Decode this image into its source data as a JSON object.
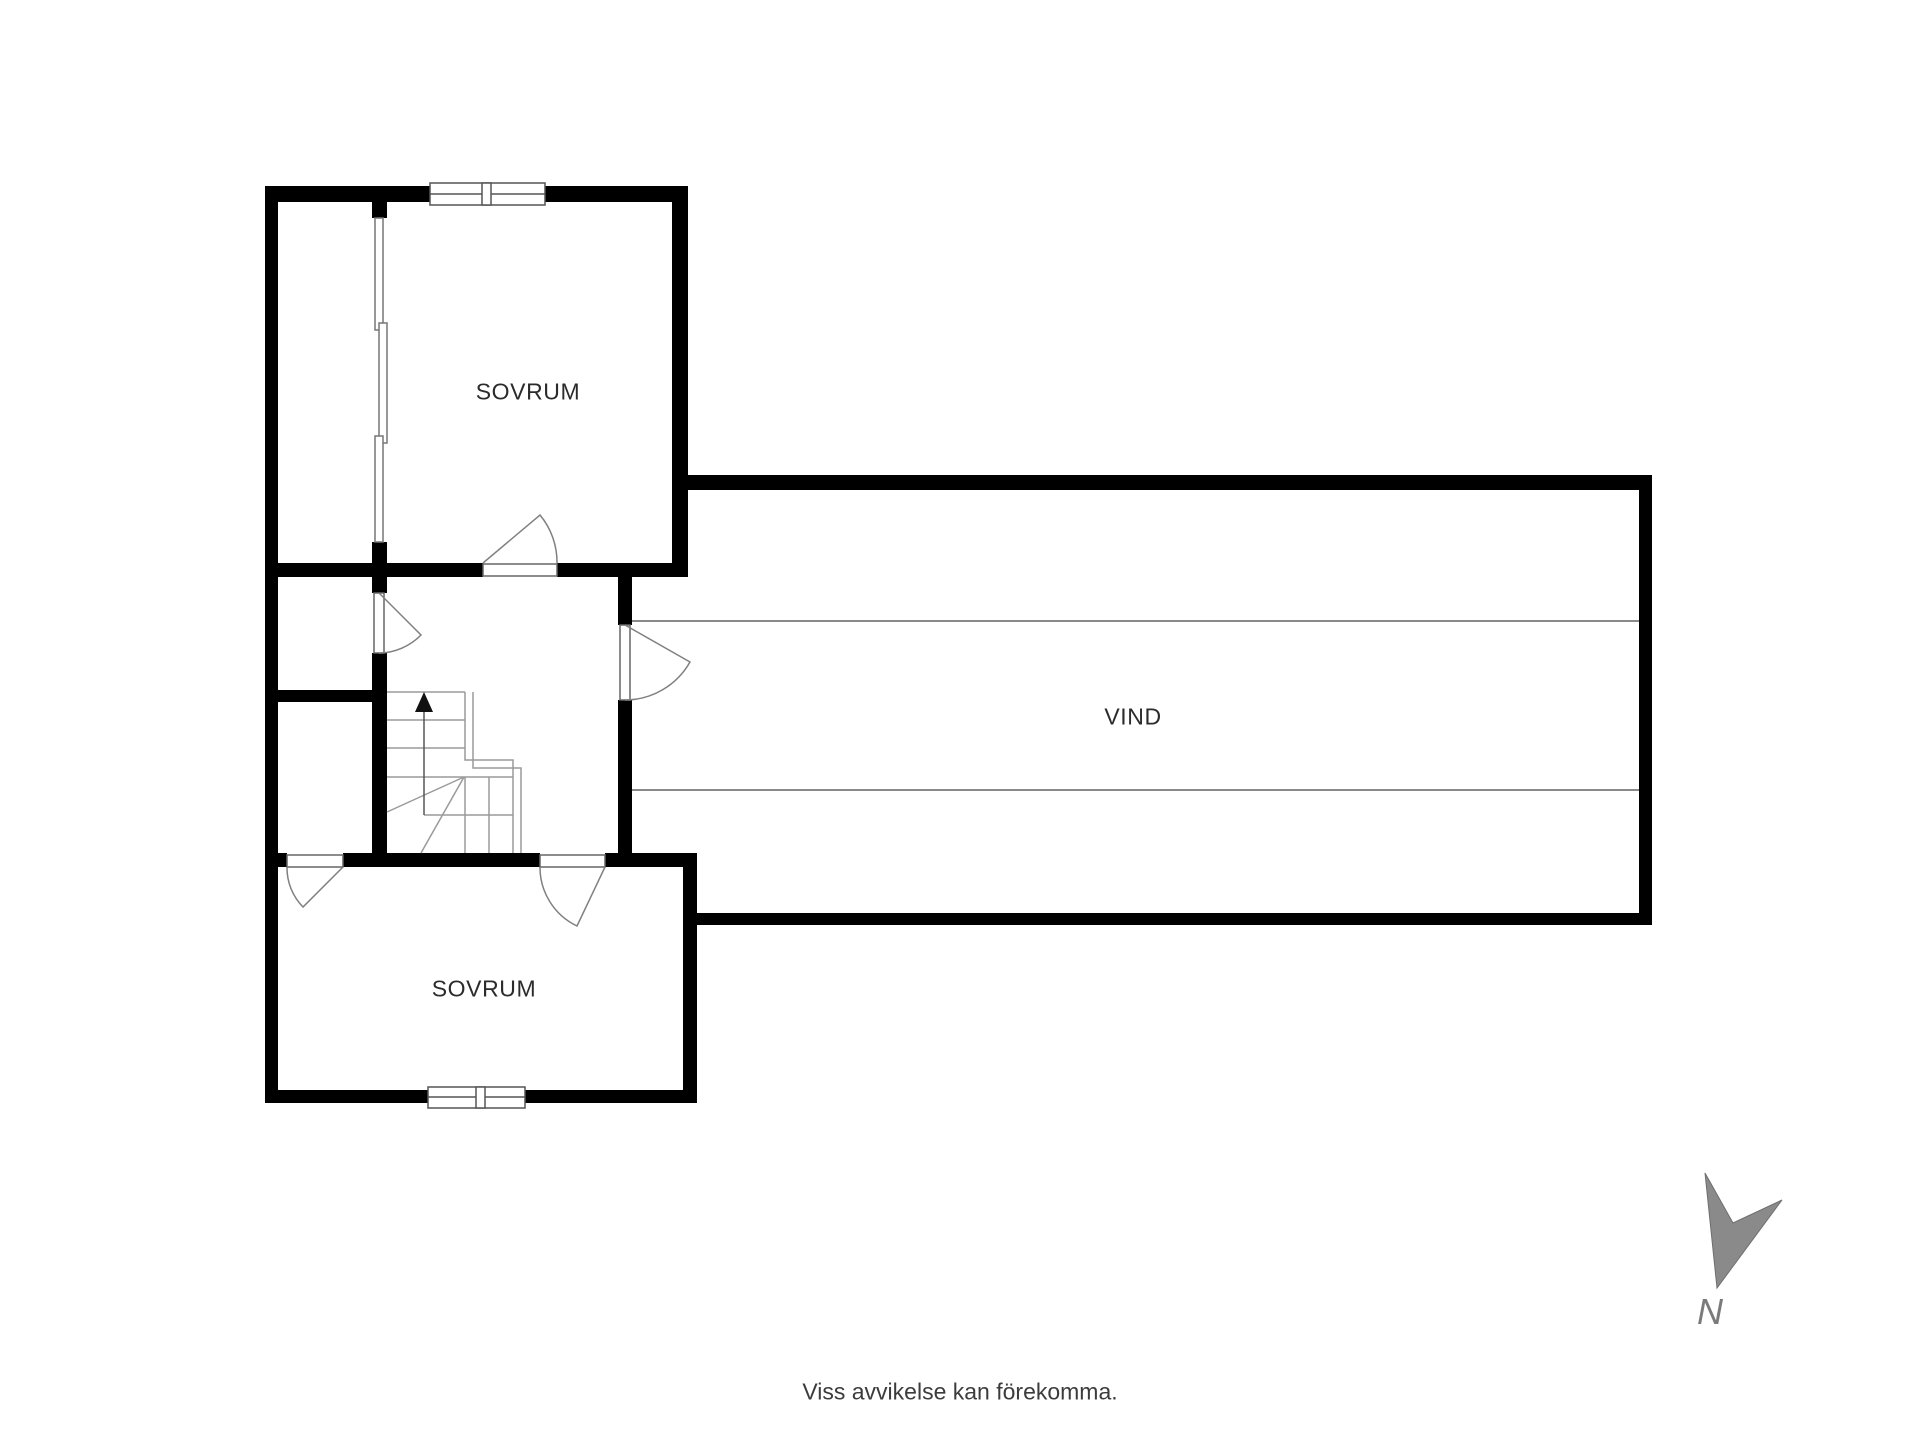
{
  "page": {
    "background_color": "#ffffff",
    "disclaimer": "Viss avvikelse kan förekomma."
  },
  "floorplan": {
    "rooms": [
      {
        "name": "sovrum-top",
        "label": "SOVRUM"
      },
      {
        "name": "vind",
        "label": "VIND"
      },
      {
        "name": "sovrum-bottom",
        "label": "SOVRUM"
      }
    ],
    "compass": {
      "label": "N"
    },
    "colors": {
      "wall": "#000000",
      "stair_line": "#9a9a9a",
      "attic_knee_line": "#8a8a8a",
      "door_arc_line": "#808080",
      "window_line": "#555555",
      "room_label": "#2b2b2b",
      "compass_arrow": "#8a8a8a",
      "compass_label": "#7a7a7a",
      "disclaimer_text": "#3c3c3c"
    }
  }
}
